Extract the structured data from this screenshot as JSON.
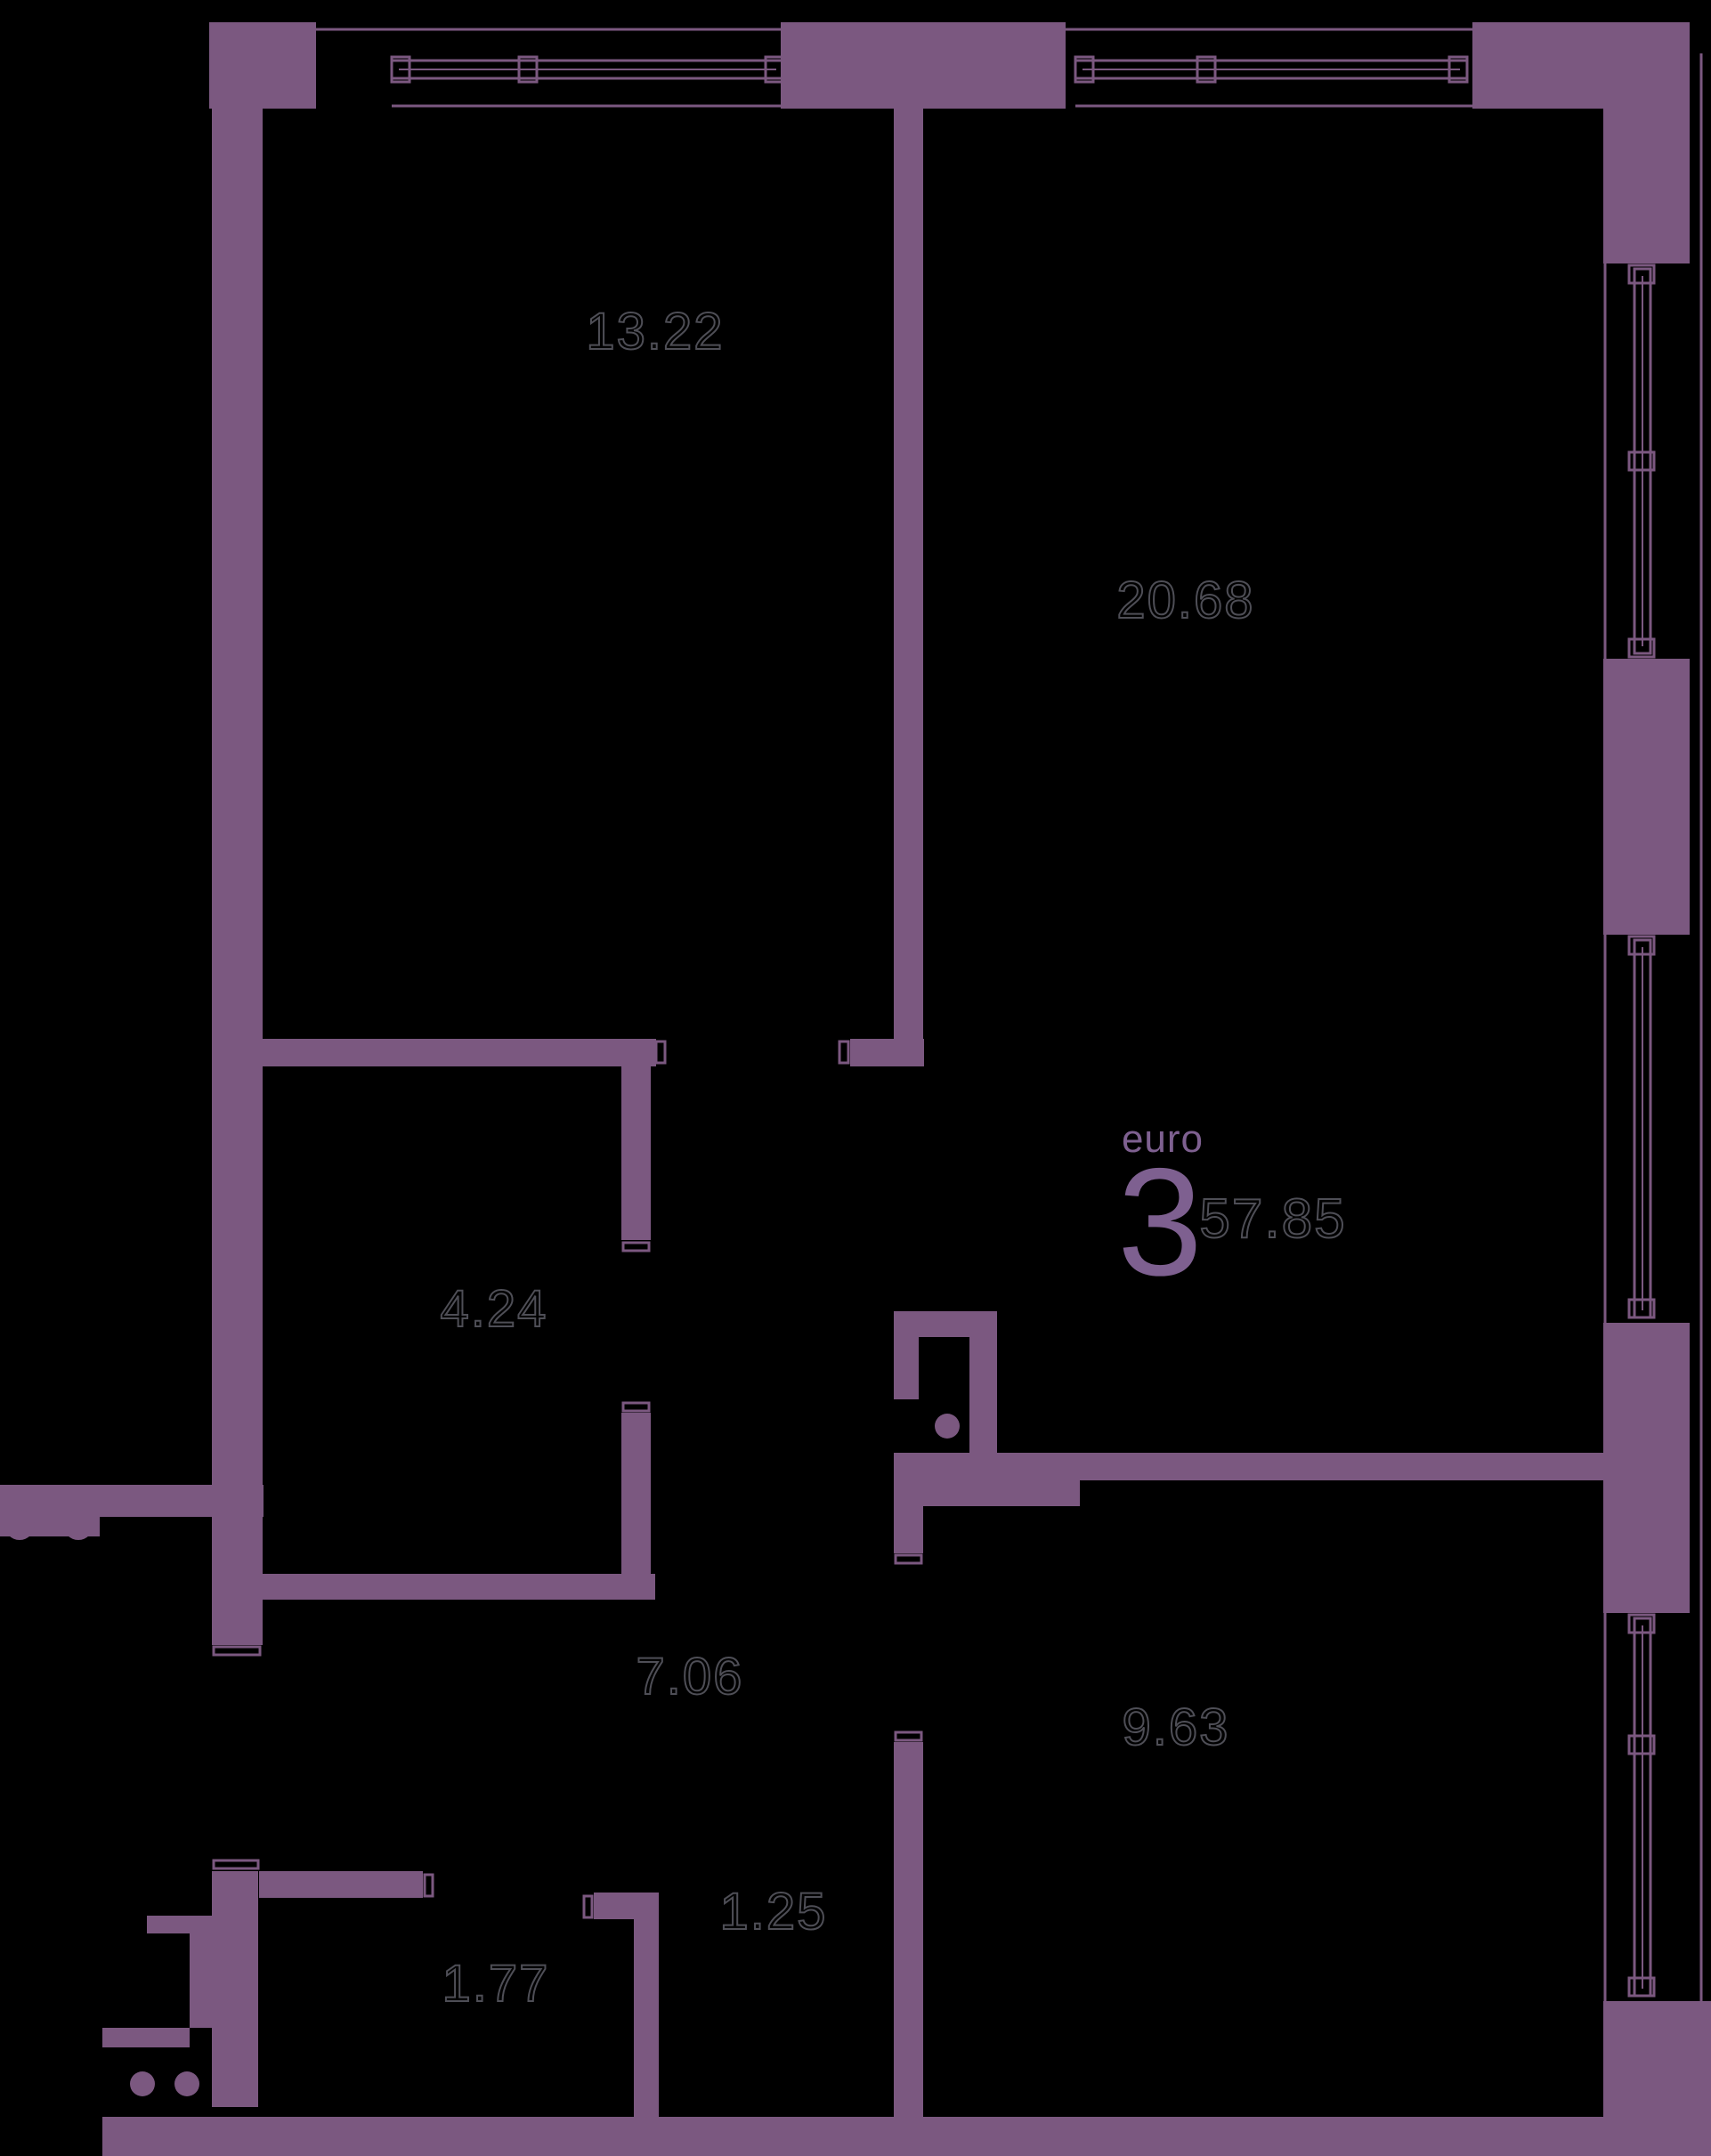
{
  "floor_plan": {
    "unit_badge": {
      "type_label": "euro",
      "room_count": "3",
      "total_area": "57.85"
    },
    "room_areas": [
      {
        "name": "bedroom",
        "value": "13.22"
      },
      {
        "name": "living-room",
        "value": "20.68"
      },
      {
        "name": "bathroom",
        "value": "4.24"
      },
      {
        "name": "hallway",
        "value": "7.06"
      },
      {
        "name": "kitchen",
        "value": "9.63"
      },
      {
        "name": "wardrobe",
        "value": "1.77"
      },
      {
        "name": "niche",
        "value": "1.25"
      }
    ],
    "colors": {
      "background": "#000000",
      "walls": "#7b5880",
      "accent_text": "#7e6090",
      "area_label_outline": "#4e4e56"
    }
  }
}
